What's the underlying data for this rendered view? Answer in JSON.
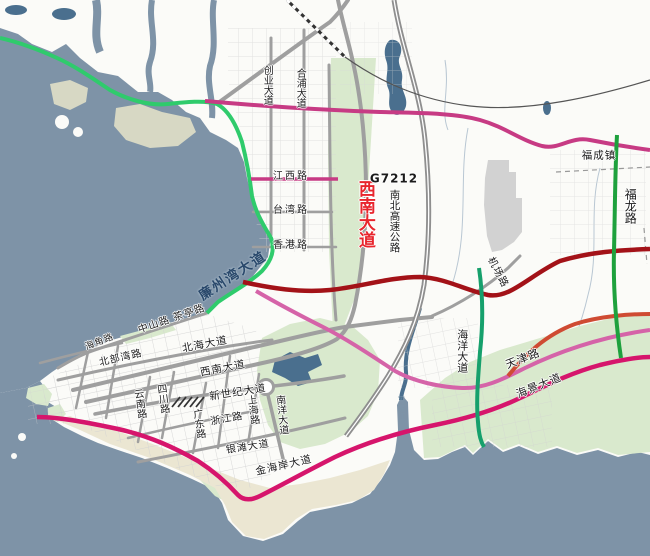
{
  "colors": {
    "sea": "#7e93a7",
    "water_dark": "#4a6f8e",
    "land": "#fbfbf8",
    "green_area": "#d9e9cd",
    "sand": "#ebe6d2",
    "flat": "#d7d8c4",
    "airport": "#d2d2d2",
    "road_gray": "#9f9f9f",
    "road_gray_minor": "#b5b5b5",
    "route_green": "#2fcb6c",
    "route_dark_green": "#1ea13d",
    "route_teal": "#16a06c",
    "route_pink": "#c73b84",
    "route_light_pink": "#d563a8",
    "route_crimson": "#d6156c",
    "route_dark_red": "#a31218",
    "route_orange": "#cf4b33",
    "label_red": "#e8262d",
    "label_navy": "#29486b"
  },
  "labels": {
    "chuangye": {
      "text": "创业大道"
    },
    "hepu": {
      "text": "合浦大道"
    },
    "jiangxi": {
      "text": "江西路"
    },
    "taiwan": {
      "text": "台湾路"
    },
    "hongkong": {
      "text": "香港路"
    },
    "xinan_corridor": {
      "text": "西南大道"
    },
    "g7212": {
      "text": "G7212"
    },
    "nanbei_expwy": {
      "text": "南北高速公路"
    },
    "fucheng": {
      "text": "福成镇"
    },
    "fulong": {
      "text": "福龙路"
    },
    "jichang": {
      "text": "机场路"
    },
    "lianzhouwan": {
      "text": "廉州湾大道"
    },
    "zhongshan_chating": {
      "text": "中山路 茶亭路"
    },
    "haijiao": {
      "text": "海角路"
    },
    "beibuwan": {
      "text": "北部湾路"
    },
    "beihai_ave": {
      "text": "北海大道"
    },
    "xinan_city": {
      "text": "西南大道"
    },
    "xinshiji": {
      "text": "新世纪大道"
    },
    "yunnan": {
      "text": "云南路"
    },
    "sichuan": {
      "text": "四川路"
    },
    "guangdong": {
      "text": "广东路"
    },
    "zhejiang": {
      "text": "浙江路"
    },
    "shanghai": {
      "text": "上海路"
    },
    "nanyang": {
      "text": "南洋大道"
    },
    "yintan": {
      "text": "银滩大道"
    },
    "jinhaian": {
      "text": "金海岸大道"
    },
    "haiyang": {
      "text": "海洋大道"
    },
    "tianjin": {
      "text": "天津路"
    },
    "haijing": {
      "text": "海景大道"
    },
    "fengjiajiang": {
      "text": "冯家江"
    }
  }
}
